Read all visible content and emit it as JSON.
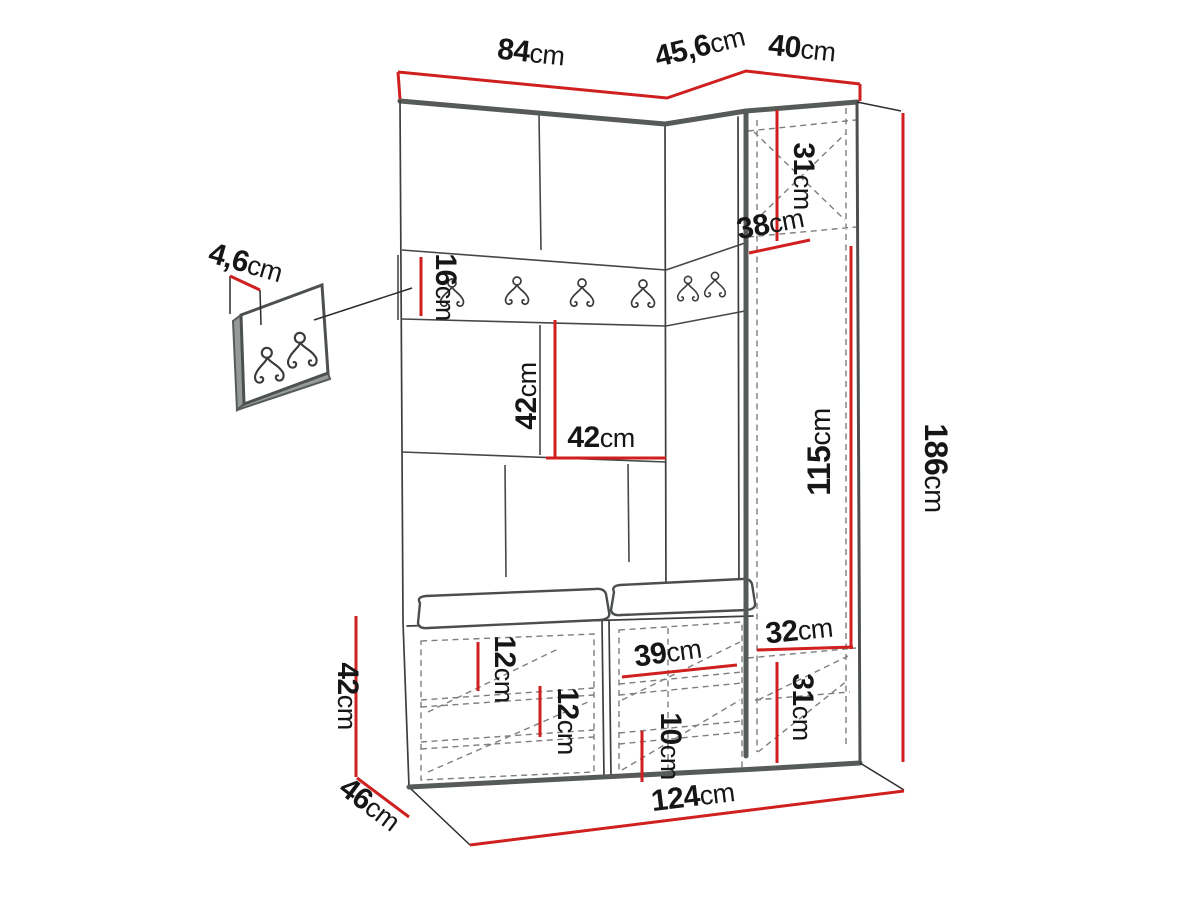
{
  "diagram": {
    "unit_default": "cm",
    "dimensions": {
      "top_main_width": {
        "value": "84",
        "unit": "cm"
      },
      "top_corner_depth": {
        "value": "45,6",
        "unit": "cm"
      },
      "top_side_width": {
        "value": "40",
        "unit": "cm"
      },
      "top_cabinet_height": {
        "value": "31",
        "unit": "cm"
      },
      "corner_depth": {
        "value": "38",
        "unit": "cm"
      },
      "rail_height": {
        "value": "16",
        "unit": "cm"
      },
      "mid_panel_height": {
        "value": "42",
        "unit": "cm"
      },
      "mid_panel_width": {
        "value": "42",
        "unit": "cm"
      },
      "side_column_height": {
        "value": "115",
        "unit": "cm"
      },
      "total_height": {
        "value": "186",
        "unit": "cm"
      },
      "hook_panel_thickness": {
        "value": "4,6",
        "unit": "cm"
      },
      "bench_height": {
        "value": "42",
        "unit": "cm"
      },
      "bench_depth": {
        "value": "46",
        "unit": "cm"
      },
      "left_shelf_gap_a": {
        "value": "12",
        "unit": "cm"
      },
      "left_shelf_gap_b": {
        "value": "12",
        "unit": "cm"
      },
      "middle_compartment_width": {
        "value": "39",
        "unit": "cm"
      },
      "middle_shelf_gap": {
        "value": "10",
        "unit": "cm"
      },
      "side_bottom_width": {
        "value": "32",
        "unit": "cm"
      },
      "side_bottom_height": {
        "value": "31",
        "unit": "cm"
      },
      "total_width": {
        "value": "124",
        "unit": "cm"
      }
    },
    "colors": {
      "dimension_red": "#cf1f1f",
      "outline_gray": "#565b58",
      "background": "#ffffff"
    }
  }
}
